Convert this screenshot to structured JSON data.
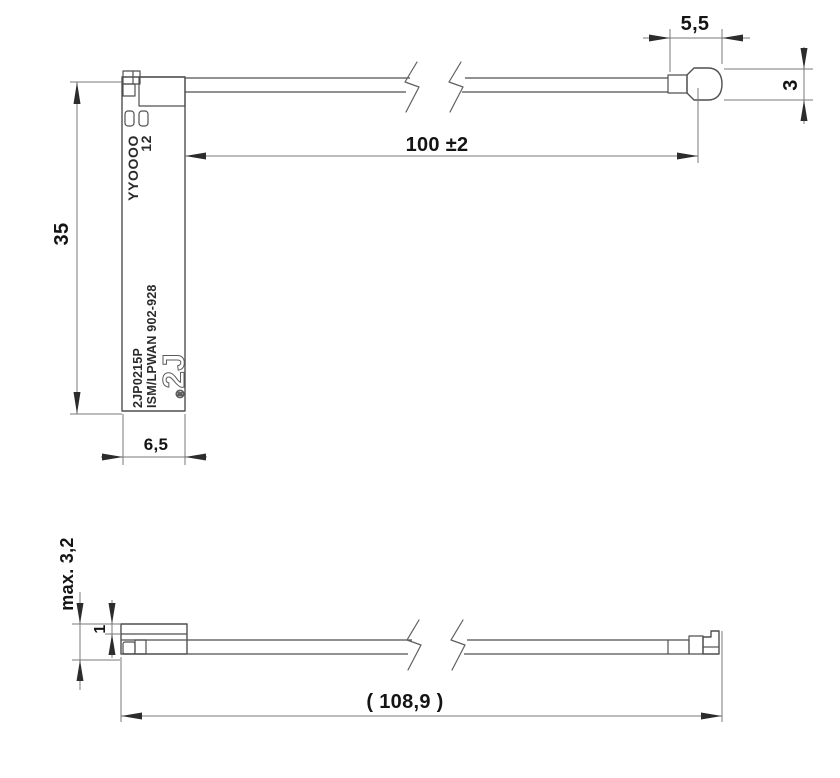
{
  "top_view": {
    "dims": {
      "pcb_height": "35",
      "pcb_width": "6,5",
      "cable_length": "100 ±2",
      "connector_length": "5,5",
      "connector_height": "3"
    },
    "pcb_text": {
      "date_code": "YYOOOO",
      "code": "12",
      "part_number": "2JP0215P",
      "band_label": "ISM/LPWAN 902-928",
      "logo_reg": "®",
      "logo": "2J"
    }
  },
  "side_view": {
    "dims": {
      "max_thickness": "max. 3,2",
      "pcb_thickness": "1",
      "overall_length": "( 108,9 )"
    }
  },
  "colors": {
    "background": "#ffffff",
    "part_outline": "#4f4f4f",
    "dimension_line": "#7a7a7a",
    "text": "#141414"
  }
}
